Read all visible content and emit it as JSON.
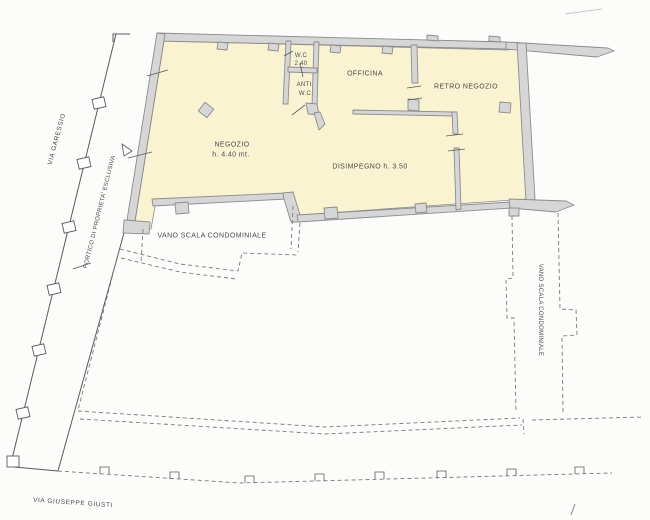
{
  "labels": {
    "via_garessio": "VIA GARESSIO",
    "portico": "PORTICO DI PROPRIETA' ESCLUSIVA",
    "negozio_name": "NEGOZIO",
    "negozio_height": "h. 4.40 mt.",
    "wc_name": "W.C",
    "wc_height": "2.40",
    "anti_wc_line1": "ANTI",
    "anti_wc_line2": "W.C",
    "officina": "OFFICINA",
    "retro_negozio": "RETRO NEGOZIO",
    "disimpegno": "DISIMPEGNO h. 3.50",
    "vano_scala_left": "VANO SCALA CONDOMINIALE",
    "vano_scala_right": "VANO SCALA CONDOMINIALE",
    "via_giuseppe_giusti": "VIA GIUSEPPE GIUSTI"
  },
  "colors": {
    "background": "#fcfcfb",
    "room_fill": "#faf3d2",
    "wall_fill": "#d6d6d6",
    "wall_stroke": "#8c8c8c",
    "line": "#5a5a5a",
    "dash": "#7a7a7a",
    "text": "#4a4a4a"
  }
}
